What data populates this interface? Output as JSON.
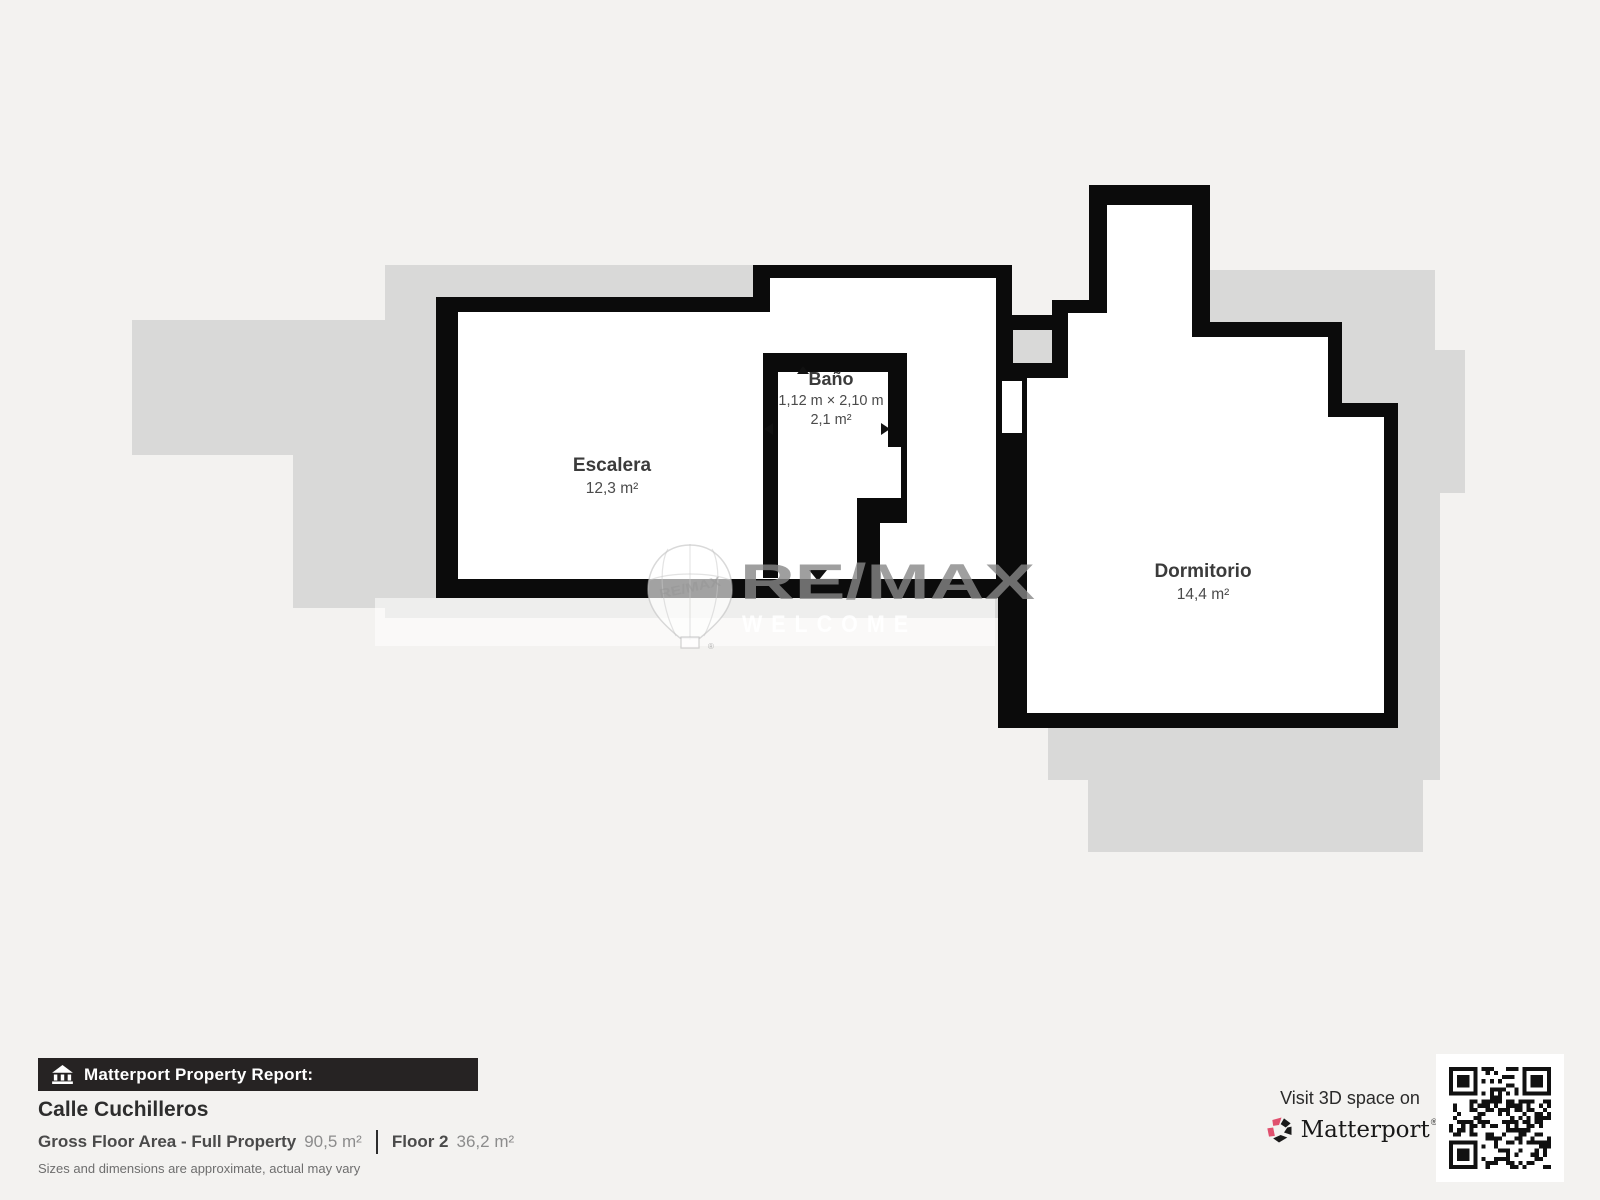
{
  "floorplan": {
    "rooms": {
      "escalera": {
        "name": "Escalera",
        "area": "12,3 m²"
      },
      "bano": {
        "name": "Baño",
        "dimensions": "1,12 m × 2,10 m",
        "area": "2,1 m²"
      },
      "dormitorio": {
        "name": "Dormitorio",
        "area": "14,4 m²"
      }
    },
    "watermark": {
      "brand": "RE/MAX",
      "sub": "WELCOME",
      "balloon_text": "RE/MAX",
      "reg": "®"
    }
  },
  "footer": {
    "report_bar_label": "Matterport Property Report:",
    "property_name": "Calle Cuchilleros",
    "stats": {
      "gross_label": "Gross Floor Area - Full Property",
      "gross_value": "90,5 m²",
      "floor_label": "Floor 2",
      "floor_value": "36,2 m²"
    },
    "disclaimer": "Sizes and dimensions are approximate, actual may vary",
    "visit_line": "Visit 3D space on",
    "visit_brand": "Matterport",
    "visit_reg": "®"
  },
  "colors": {
    "background": "#f3f2f0",
    "underlay_gray": "#d9d9d8",
    "wall_black": "#0b0b0b",
    "room_white": "#ffffff",
    "label_dark": "#3b3b3b",
    "label_mid": "#4b4b4b",
    "matterport_pink": "#e0506e",
    "footer_bar": "#262323"
  }
}
